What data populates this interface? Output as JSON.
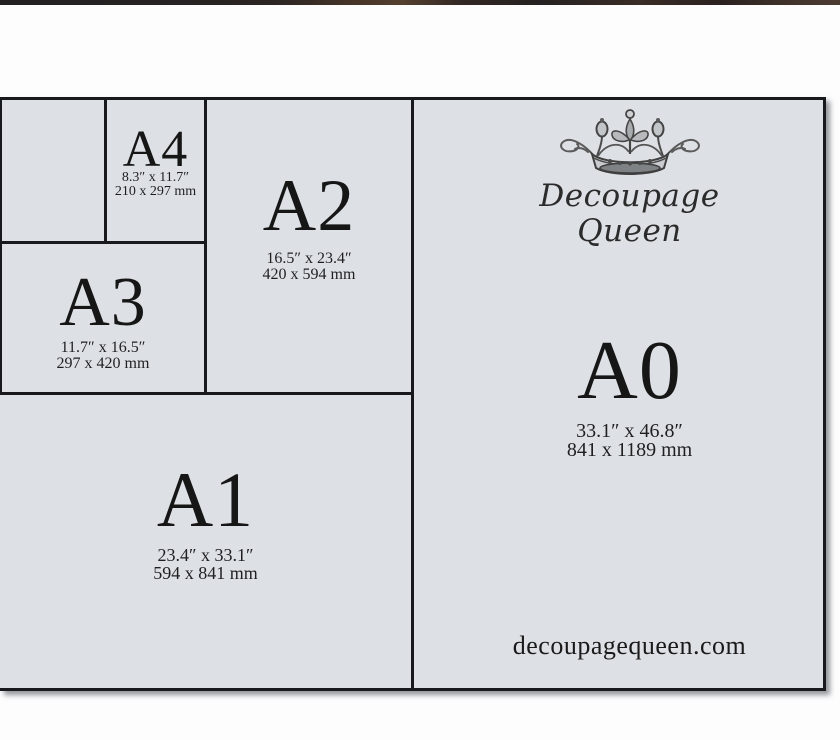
{
  "page": {
    "background": "#fdfdfe",
    "photo_edge_color": "#2b2423"
  },
  "diagram": {
    "fill_color": "#dde1e5",
    "line_color": "#17191c",
    "text_color": "#1a1a1a",
    "cells": [
      {
        "id": "a4",
        "label": "A4",
        "inches": "8.3″ x 11.7″",
        "mm": "210 x 297 mm"
      },
      {
        "id": "a2",
        "label": "A2",
        "inches": "16.5″ x 23.4″",
        "mm": "420 x 594 mm"
      },
      {
        "id": "a3",
        "label": "A3",
        "inches": "11.7″ x 16.5″",
        "mm": "297 x 420 mm"
      },
      {
        "id": "a1",
        "label": "A1",
        "inches": "23.4″ x 33.1″",
        "mm": "594 x 841 mm"
      },
      {
        "id": "a0",
        "label": "A0",
        "inches": "33.1″ x 46.8″",
        "mm": "841 x 1189 mm"
      }
    ],
    "brand": {
      "crown_icon": "crown-icon",
      "name_line1": "Decoupage",
      "name_line2": "Queen",
      "website": "decoupagequeen.com"
    }
  }
}
